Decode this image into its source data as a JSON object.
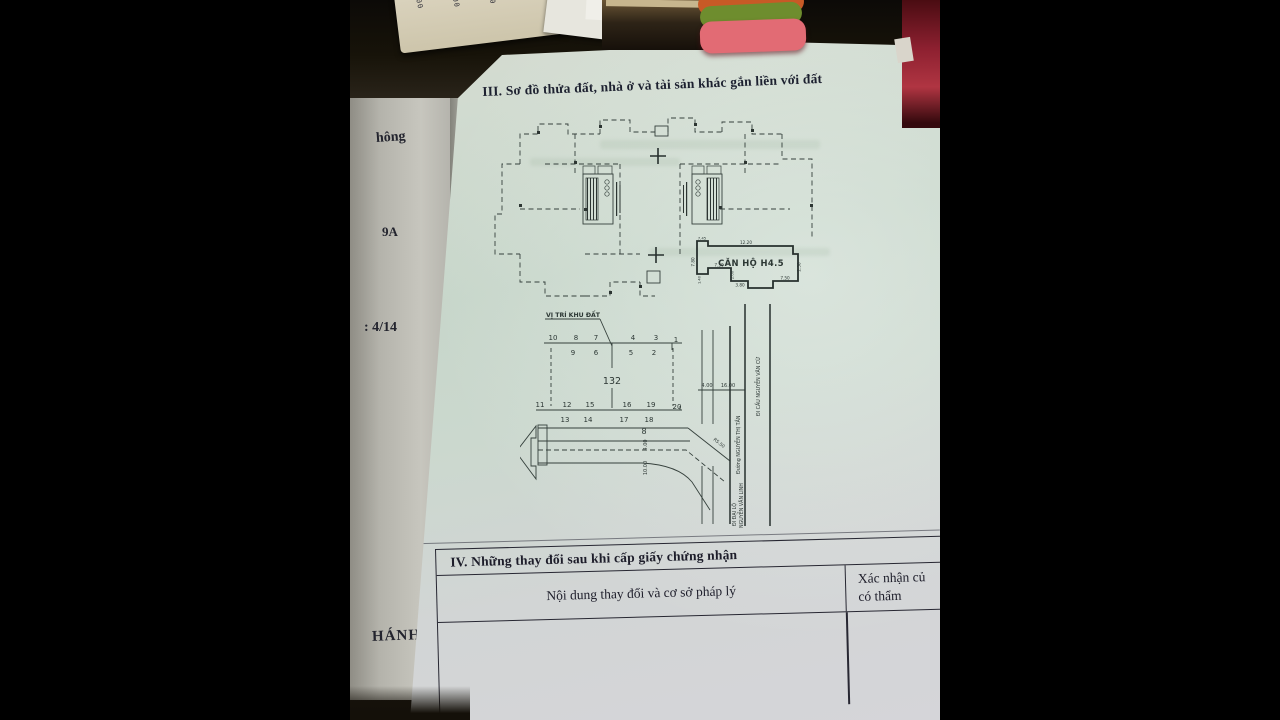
{
  "section3": {
    "title": "III. Sơ đồ thửa đất, nhà ở và tài sản khác gắn liền với đất",
    "floor_plan": {
      "unit_label": "CĂN HỘ H4.5",
      "dim_top": "12.20",
      "dim_left_top": "7.45",
      "dim_left": "7.80",
      "dim_inner": "7.30",
      "dim_step": "2.00",
      "dim_bottom": "3.80",
      "dim_bottom_right": "7.50",
      "dim_right": "2.50",
      "dim_left_low": "1.40"
    },
    "site_plan": {
      "location_label": "VỊ TRÍ KHU ĐẤT",
      "lot_number": "132",
      "road_lot": "8",
      "lots_top_upper": [
        "10",
        "8",
        "7",
        "4",
        "3",
        "1"
      ],
      "lots_top_lower": [
        "9",
        "6",
        "5",
        "2"
      ],
      "lots_bottom_upper": [
        "11",
        "12",
        "15",
        "16",
        "19",
        "20"
      ],
      "lots_bottom_lower": [
        "13",
        "14",
        "17",
        "18"
      ],
      "dim_a": "4.00",
      "dim_b": "16.00",
      "road_dim_a": "4.00",
      "road_dim_b": "10.00",
      "curve_radius": "R5.50",
      "street_name": "Đường NGUYỄN THỊ TẦN",
      "direction_top": "ĐI CẦU NGUYỄN VĂN CỪ",
      "direction_bottom_1": "ĐI ĐẠI LỘ",
      "direction_bottom_2": "NGUYỄN VĂN LINH"
    }
  },
  "section4": {
    "title": "IV. Những thay đổi sau khi cấp giấy chứng nhận",
    "col_content": "Nội dung thay đổi và cơ sở pháp lý",
    "col_confirm_line1": "Xác nhận củ",
    "col_confirm_line2": "có thẩm"
  },
  "left_page": {
    "fragment_1": "hông",
    "fragment_2": "9A",
    "fragment_3": ": 4/14",
    "fragment_4": "HÁNH"
  },
  "receipt": {
    "col1": "1.000",
    "col2": "38.000",
    "col3": "10.000",
    "col4": "30.000"
  }
}
